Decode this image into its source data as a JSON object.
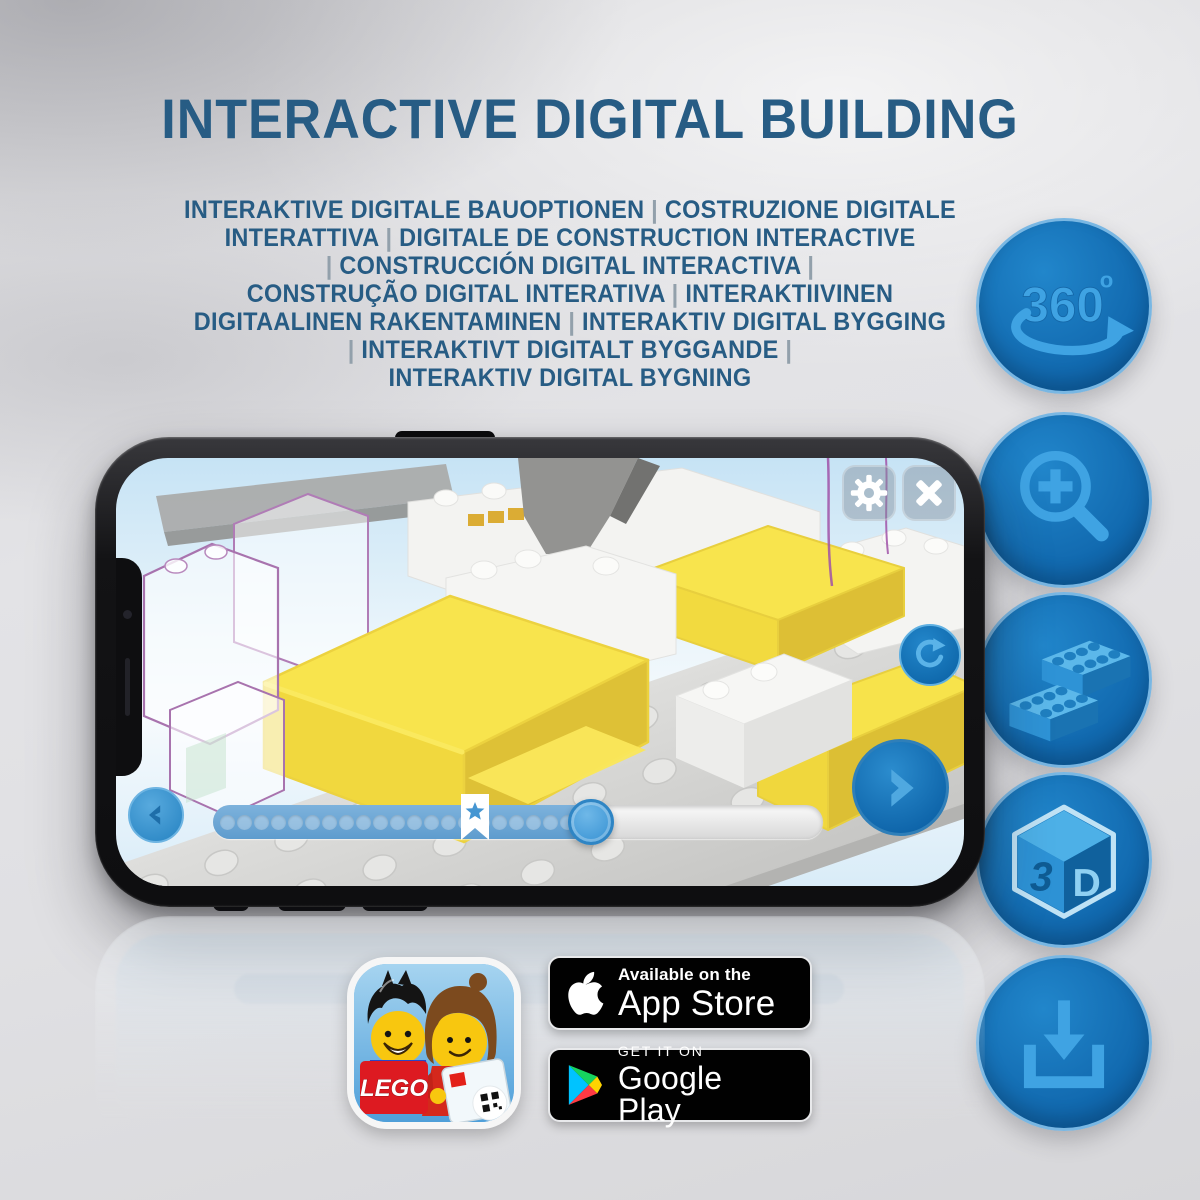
{
  "title": "INTERACTIVE DIGITAL BUILDING",
  "subtitle": "INTERAKTIVE DIGITALE BAUOPTIONEN | COSTRUZIONE DIGITALE\nINTERATTIVA | DIGITALE DE CONSTRUCTION INTERACTIVE\n| CONSTRUCCIÓN DIGITAL INTERACTIVA |\nCONSTRUÇÃO DIGITAL INTERATIVA | INTERAKTIIVINEN\nDIGITAALINEN RAKENTAMINEN | INTERAKTIV DIGITAL BYGGING\n| INTERAKTIVT DIGITALT BYGGANDE |\nINTERAKTIV DIGITAL BYGNING",
  "feature_icons": [
    {
      "name": "360-rotation-icon",
      "text": "360",
      "superscript": "o"
    },
    {
      "name": "zoom-in-icon"
    },
    {
      "name": "bricks-icon"
    },
    {
      "name": "3d-cube-icon",
      "left_face": "3",
      "right_face": "D"
    },
    {
      "name": "download-icon"
    }
  ],
  "phone": {
    "progress": {
      "dot_count": 21,
      "fill_percent": 62,
      "marker_percent": 43
    }
  },
  "store_badges": {
    "app_store": {
      "tagline": "Available on the",
      "store": "App Store"
    },
    "google_play": {
      "tagline": "GET IT ON",
      "store": "Google Play"
    }
  },
  "app_icon": {
    "lego_logo": "LEGO"
  },
  "colors": {
    "title_blue": "#275c84",
    "icon_circle_blue": "#1373bd",
    "icon_glyph_blue": "#3fa3e3",
    "screen_button_blue": "#1b7ac2",
    "progress_fill_blue": "#6aa7d5",
    "lego_yellow": "#f8e44d",
    "badge_black": "#010101"
  }
}
